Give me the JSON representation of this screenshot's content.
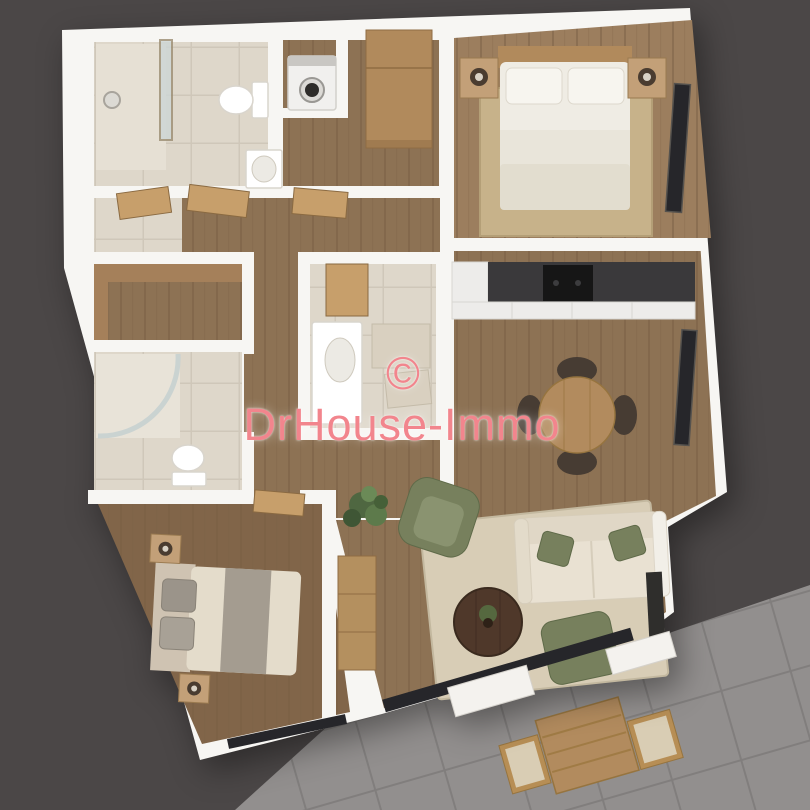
{
  "watermark": {
    "symbol": "©",
    "brand": "DrHouse-Immo"
  },
  "palette": {
    "bg": "#4b4747",
    "terrace": "#928f8e",
    "grout": "#817e7d",
    "wall": "#f7f6f3",
    "wood": "#8d7254",
    "woodLine": "#796045",
    "woodLight": "#9c7e5e",
    "woodDark": "#816549",
    "tile": "#ded7ca",
    "tileLine": "#cfc7b9",
    "rugTan": "#c7b28a",
    "rugBeige": "#d8cdb6",
    "sofa": "#e9e1d2",
    "green": "#77805d",
    "greenLight": "#8a9370",
    "counter": "#3a393b",
    "cooktop": "#161616",
    "tableWood": "#b28b5e",
    "furnWood": "#c3a078",
    "doorWood": "#c79f6b",
    "chairDark": "#473c33",
    "windowDark": "#26262a",
    "bedWhite": "#efece4",
    "bedBeige": "#e4dccb",
    "bandGray": "#a49c90",
    "coffeeTable": "#4f382a",
    "plantGreen": "#55683f",
    "machine": "#f1f0ee",
    "sill": "#f4f2ee",
    "watermark": "#f2858d"
  },
  "rooms": [
    "bathroom-top-left",
    "laundry-closet",
    "entry-hall",
    "hallway",
    "wardrobe-cabinet",
    "bedroom-1-top-right",
    "kitchen",
    "dining-area",
    "wc-center",
    "dressing-room",
    "bathroom-left",
    "bedroom-2-bottom-left",
    "living-room",
    "terrace"
  ],
  "furniture": [
    "shower",
    "toilet",
    "sink",
    "washing-machine",
    "double-bed-white",
    "nightstands-with-lamps",
    "area-rug",
    "kitchen-counter-with-cooktop",
    "round-dining-table-4-chairs",
    "curved-shower",
    "double-bed-beige",
    "cream-sofa-green-pillows",
    "green-armchair",
    "green-pouf",
    "round-coffee-table",
    "potted-plant",
    "sideboard",
    "outdoor-table-2-chairs",
    "windows"
  ]
}
